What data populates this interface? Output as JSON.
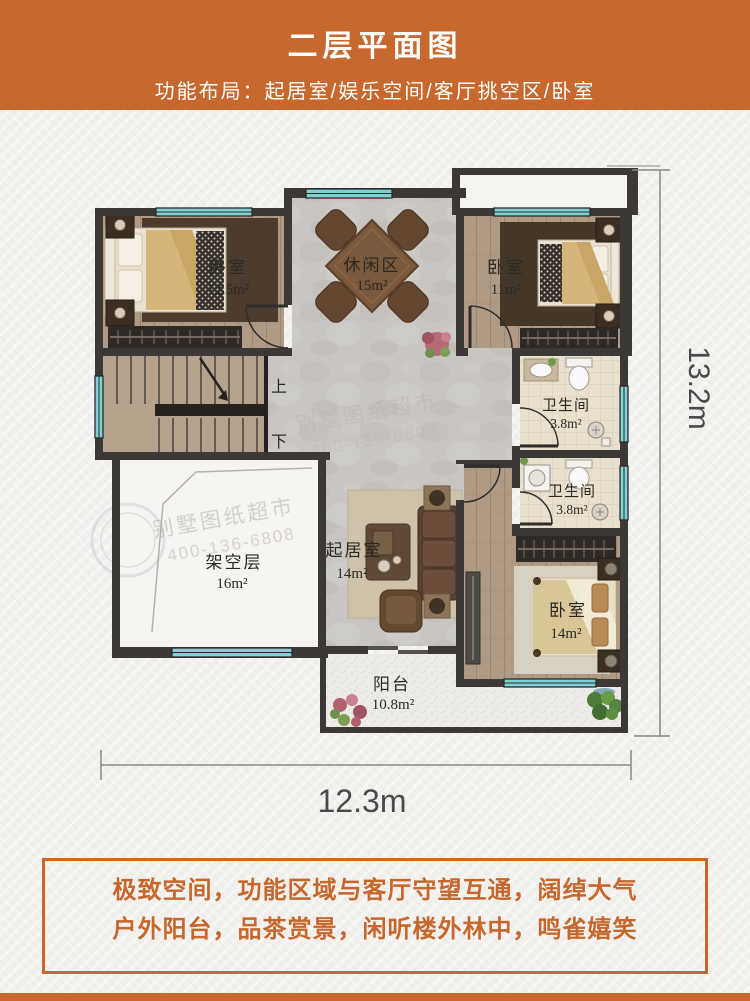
{
  "header": {
    "title": "二层平面图",
    "subtitle": "功能布局：起居室/娱乐空间/客厅挑空区/卧室"
  },
  "plan": {
    "rooms": {
      "bedroom_top_left": {
        "label": "卧室",
        "area": "12.5m²"
      },
      "leisure": {
        "label": "休闲区",
        "area": "15m²"
      },
      "bedroom_top_right": {
        "label": "卧室",
        "area": "11m²"
      },
      "bathroom_upper": {
        "label": "卫生间",
        "area": "3.8m²"
      },
      "bathroom_lower": {
        "label": "卫生间",
        "area": "3.8m²"
      },
      "void_deck": {
        "label": "架空层",
        "area": "16m²"
      },
      "living": {
        "label": "起居室",
        "area": "14m²"
      },
      "bedroom_bottom_right": {
        "label": "卧室",
        "area": "14m²"
      },
      "balcony": {
        "label": "阳台",
        "area": "10.8m²"
      }
    },
    "stairs": {
      "up": "上",
      "down": "下"
    },
    "dimensions": {
      "height": "13.2m",
      "width": "12.3m"
    },
    "watermark": {
      "name": "别墅图纸超市",
      "phone": "400-136-6808"
    }
  },
  "footer": {
    "line1": "极致空间，功能区域与客厅守望互通，阔绰大气",
    "line2": "户外阳台，品茶赏景，闲听楼外林中，鸣雀嬉笑"
  },
  "colors": {
    "banner": "#c7692e",
    "accent_text": "#c7672c",
    "wall": "#3b3836",
    "window": "#7fd2d4",
    "dimension_text": "#4a4a4a"
  }
}
